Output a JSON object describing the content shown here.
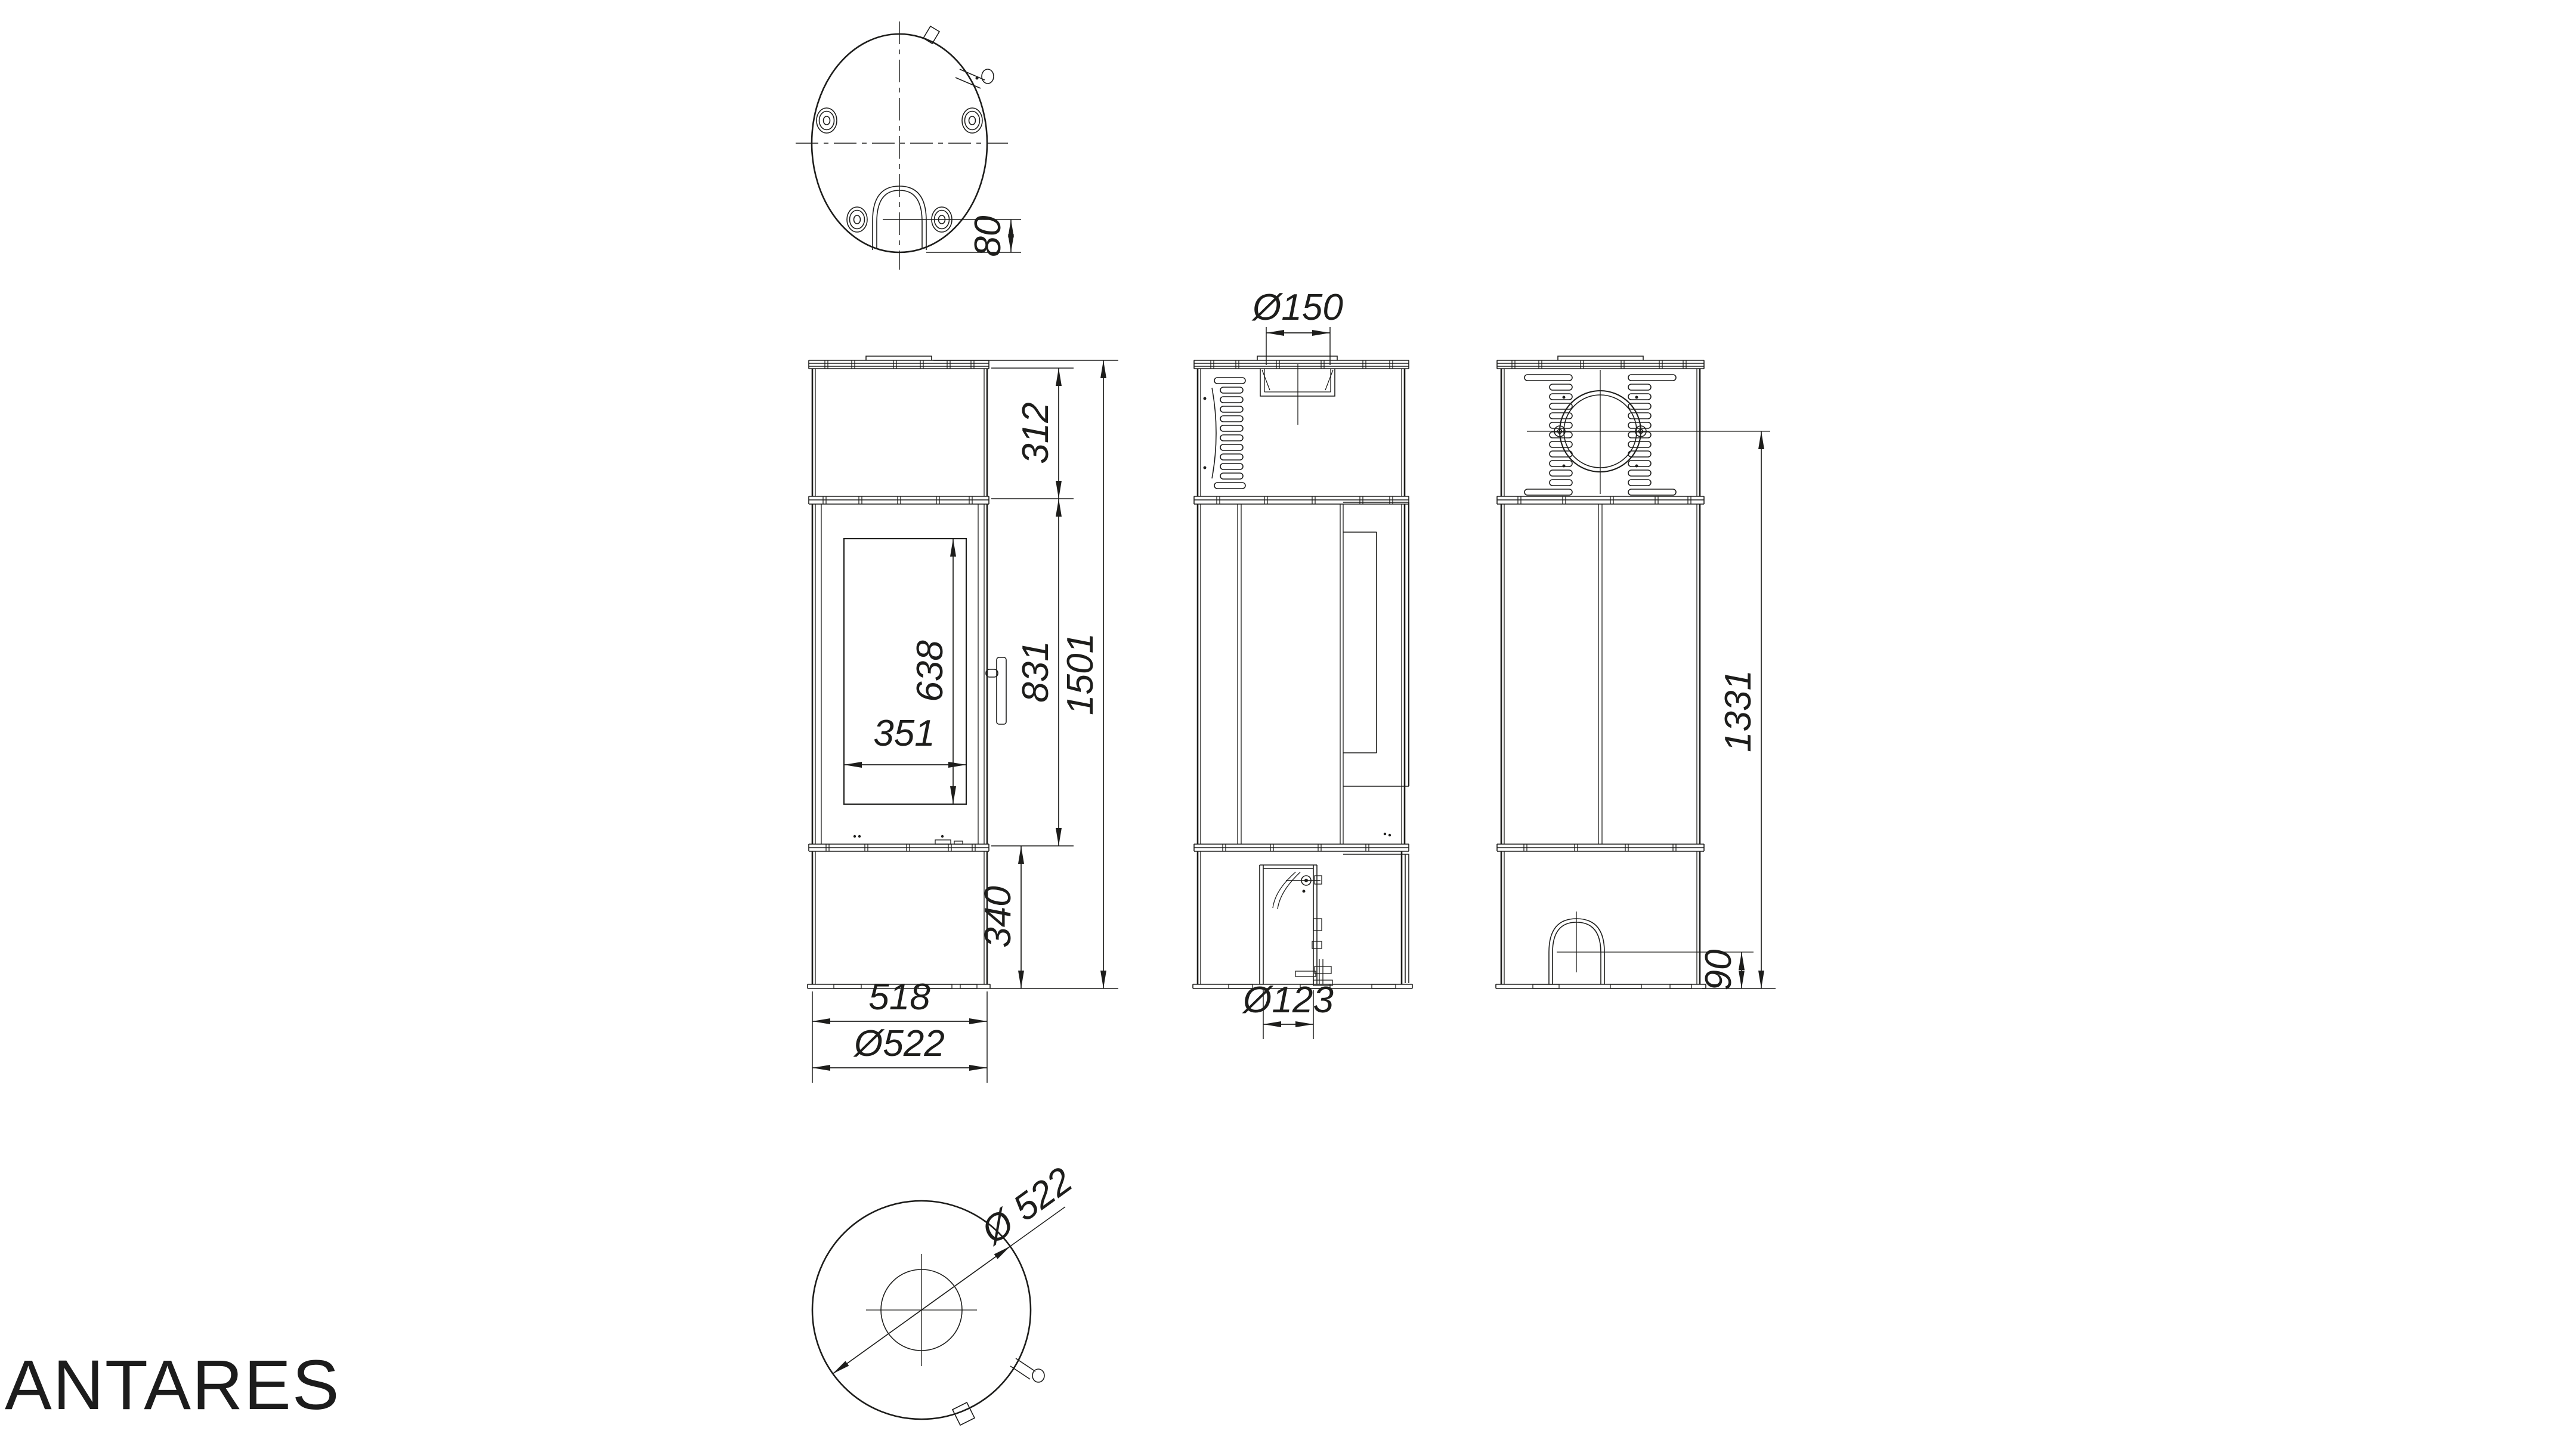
{
  "title": "ANTARES",
  "line_color": "#1d1d1b",
  "dims": {
    "top_foot_offset": "80",
    "flue_diameter": "Ø150",
    "upper_section_height": "312",
    "door_section_height": "831",
    "total_height": "1501",
    "glass_height": "638",
    "glass_width": "351",
    "base_height": "340",
    "body_width": "518",
    "body_diameter": "Ø522",
    "intake_diameter": "Ø123",
    "flue_axis_height": "1331",
    "intake_axis_height": "90",
    "footprint_diameter": "Ø 522"
  }
}
